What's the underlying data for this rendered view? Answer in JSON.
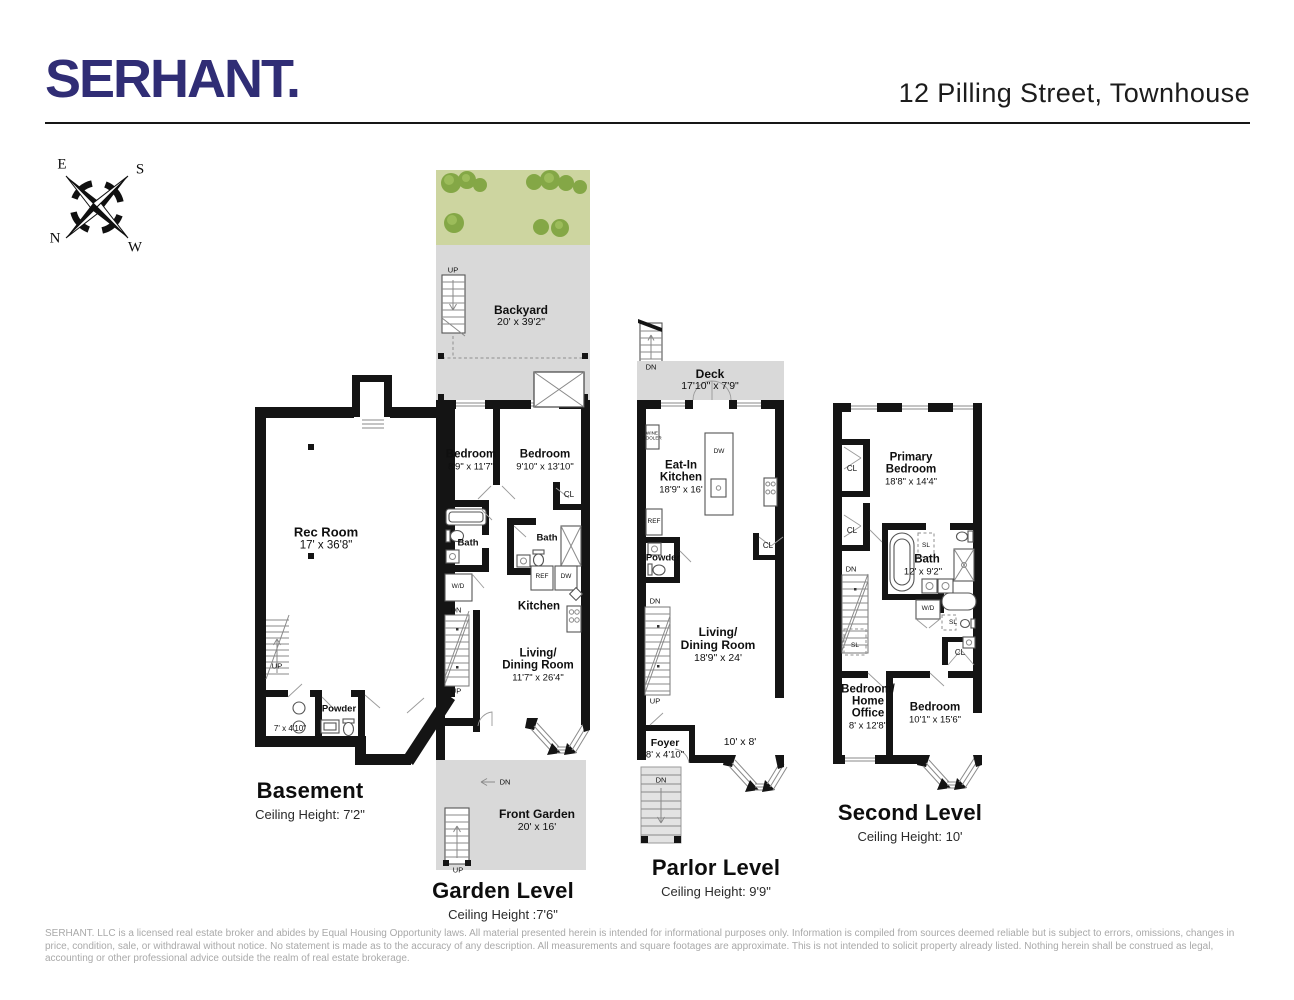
{
  "colors": {
    "brand": "#302d75",
    "wall": "#141414",
    "outdoor": "#d9d9d9",
    "grass": "#c6cf9b",
    "bush": "#84a746",
    "muted": "#a9a9a9"
  },
  "header": {
    "brand": "SERHANT.",
    "title": "12 Pilling Street, Townhouse"
  },
  "compass": {
    "e": "E",
    "s": "S",
    "n": "N",
    "w": "W"
  },
  "labels": {
    "up": "UP",
    "dn": "DN",
    "cl": "CL",
    "sl": "SL",
    "wd": "W/D",
    "ref": "REF",
    "dw": "DW",
    "wine1": "WINE",
    "wine2": "COOLER"
  },
  "floors": {
    "basement": {
      "title": "Basement",
      "ceiling": "Ceiling Height: 7'2\"",
      "rec_room": {
        "name": "Rec Room",
        "dims": "17' x 36'8\""
      },
      "laundry_dims": "7' x 4'10\"",
      "powder": "Powder"
    },
    "garden": {
      "title": "Garden Level",
      "ceiling": "Ceiling Height :7'6\"",
      "backyard": {
        "name": "Backyard",
        "dims": "20' x 39'2\""
      },
      "bedroom_left": {
        "name": "Bedroom",
        "dims": "8'9\" x 11'7\""
      },
      "bedroom_right": {
        "name": "Bedroom",
        "dims": "9'10\" x 13'10\""
      },
      "bath_left": "Bath",
      "bath_right": "Bath",
      "kitchen": "Kitchen",
      "living": {
        "line1": "Living/",
        "line2": "Dining Room",
        "dims": "11'7\" x 26'4\""
      },
      "front_garden": {
        "name": "Front Garden",
        "dims": "20' x 16'"
      }
    },
    "parlor": {
      "title": "Parlor Level",
      "ceiling": "Ceiling Height: 9'9\"",
      "deck": {
        "name": "Deck",
        "dims": "17'10\" x 7'9\""
      },
      "eat_in_kitchen": {
        "line1": "Eat-In",
        "line2": "Kitchen",
        "dims": "18'9\" x 16'"
      },
      "powder": "Powder",
      "living": {
        "line1": "Living/",
        "line2": "Dining Room",
        "dims": "18'9\" x 24'"
      },
      "foyer": {
        "name": "Foyer",
        "dims": "8' x 4'10\""
      },
      "bay_dims": "10' x 8'"
    },
    "second": {
      "title": "Second Level",
      "ceiling": "Ceiling Height: 10'",
      "primary": {
        "line1": "Primary",
        "line2": "Bedroom",
        "dims": "18'8\" x 14'4\""
      },
      "bath": {
        "name": "Bath",
        "dims": "12' x 9'2\""
      },
      "bedroom_office": {
        "line1": "Bedroom/",
        "line2": "Home",
        "line3": "Office",
        "dims": "8' x 12'8\""
      },
      "bedroom": {
        "name": "Bedroom",
        "dims": "10'1\" x 15'6\""
      }
    }
  },
  "footer": {
    "disclaimer": "SERHANT. LLC is a licensed real estate broker and abides by Equal Housing Opportunity laws. All material presented herein is intended for informational purposes only. Information is compiled from sources deemed reliable but is subject to errors, omissions, changes in price, condition, sale, or withdrawal without notice. No statement is made as to the accuracy of any description. All measurements and square footages are approximate. This is not intended to solicit property already listed. Nothing herein shall be construed as legal, accounting or other professional advice outside the realm of real estate brokerage."
  }
}
